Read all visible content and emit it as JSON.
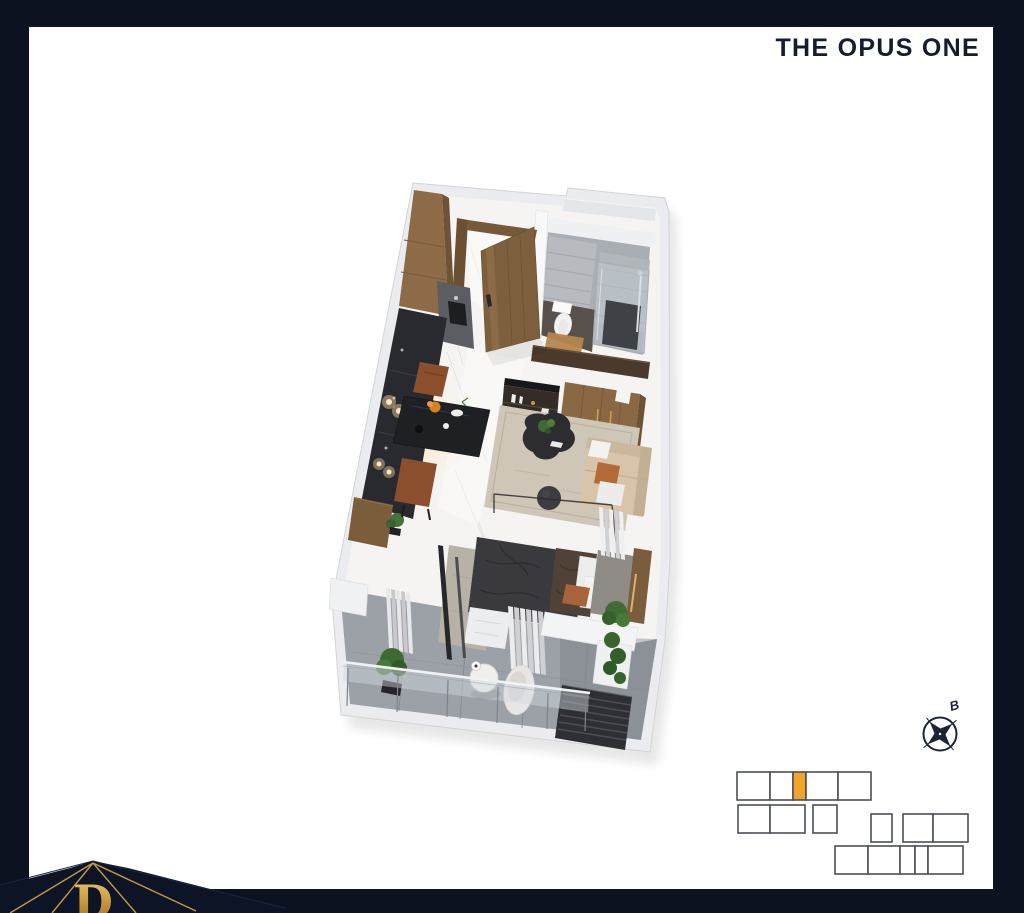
{
  "header": {
    "title": "THE OPUS ONE"
  },
  "compass": {
    "label": "B",
    "icon": "compass-rose-icon"
  },
  "logo": {
    "letter": "D"
  },
  "colors": {
    "frame": "#0d1220",
    "page": "#ffffff",
    "title_text": "#141c2e",
    "highlight": "#f2a32a",
    "locator_stroke": "#4b4f58",
    "gold": "#c59a44"
  },
  "floor_plan": {
    "type": "3d-isometric-apartment-render",
    "elements": [
      "entry-door",
      "kitchen-cabinets",
      "dining-table",
      "dining-chairs",
      "pendant-lights",
      "bathroom",
      "toilet",
      "shower",
      "vanity-cabinet",
      "wardrobe",
      "sofa",
      "coffee-table",
      "area-rug",
      "bed",
      "bedroom-rug",
      "curtains",
      "glass-partition",
      "balcony",
      "glass-railing",
      "outdoor-table",
      "outdoor-chair",
      "plants",
      "ac-unit",
      "marble-floor"
    ]
  },
  "locator": {
    "highlighted_cell_index": 2,
    "cells": [
      {
        "x": 737,
        "y": 772,
        "w": 33,
        "h": 28,
        "highlight": false
      },
      {
        "x": 770,
        "y": 772,
        "w": 23,
        "h": 28,
        "highlight": false
      },
      {
        "x": 793,
        "y": 772,
        "w": 13,
        "h": 28,
        "highlight": true
      },
      {
        "x": 806,
        "y": 772,
        "w": 32,
        "h": 28,
        "highlight": false
      },
      {
        "x": 838,
        "y": 772,
        "w": 33,
        "h": 28,
        "highlight": false
      },
      {
        "x": 738,
        "y": 805,
        "w": 32,
        "h": 28,
        "highlight": false
      },
      {
        "x": 770,
        "y": 805,
        "w": 35,
        "h": 28,
        "highlight": false
      },
      {
        "x": 813,
        "y": 805,
        "w": 24,
        "h": 28,
        "highlight": false
      },
      {
        "x": 871,
        "y": 814,
        "w": 21,
        "h": 28,
        "highlight": false
      },
      {
        "x": 903,
        "y": 814,
        "w": 30,
        "h": 28,
        "highlight": false
      },
      {
        "x": 933,
        "y": 814,
        "w": 35,
        "h": 28,
        "highlight": false
      },
      {
        "x": 835,
        "y": 846,
        "w": 33,
        "h": 28,
        "highlight": false
      },
      {
        "x": 868,
        "y": 846,
        "w": 32,
        "h": 28,
        "highlight": false
      },
      {
        "x": 900,
        "y": 846,
        "w": 15,
        "h": 28,
        "highlight": false
      },
      {
        "x": 915,
        "y": 846,
        "w": 13,
        "h": 28,
        "highlight": false
      },
      {
        "x": 928,
        "y": 846,
        "w": 35,
        "h": 28,
        "highlight": false
      }
    ]
  }
}
